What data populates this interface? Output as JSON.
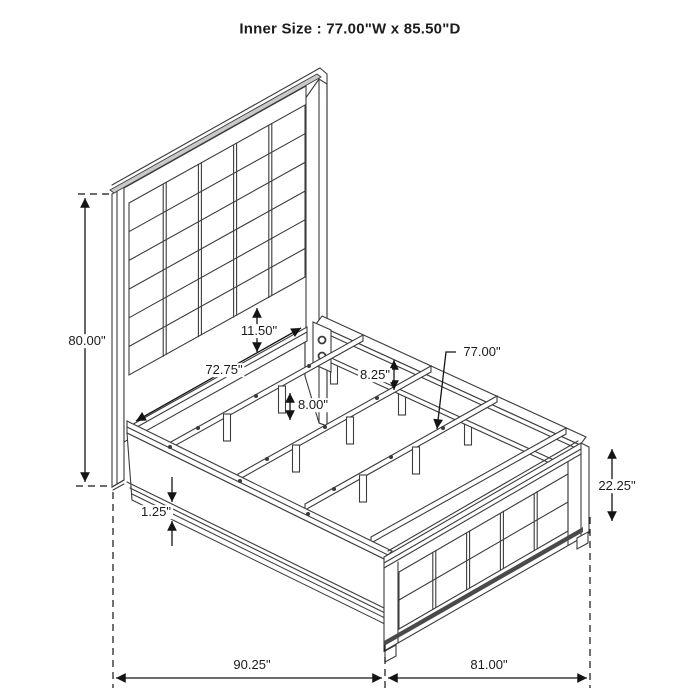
{
  "title": "Inner Size : 77.00\"W x 85.50\"D",
  "dimensions": {
    "headboard_height": "80.00\"",
    "headboard_inner_width": "72.75\"",
    "panel_to_rail_gap": "11.50\"",
    "side_rail_height": "8.25\"",
    "slat_leg_height": "8.00\"",
    "slat_inner_width": "77.00\"",
    "footboard_height": "22.25\"",
    "rail_bottom_thickness": "1.25\"",
    "overall_depth": "90.25\"",
    "overall_width": "81.00\""
  }
}
